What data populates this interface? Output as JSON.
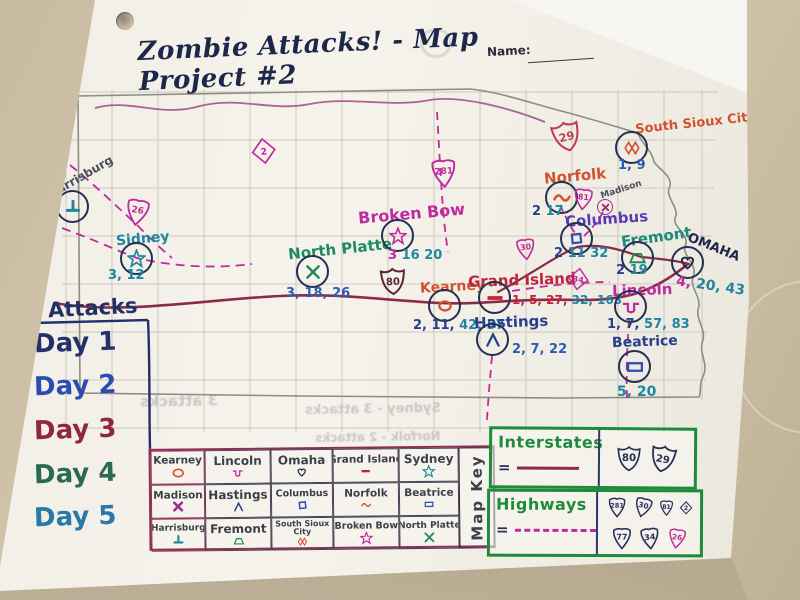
{
  "title": "Zombie Attacks! - Map Project #2",
  "name_label": "Name:",
  "attacks_panel": {
    "header": "Attacks",
    "days": [
      "Day 1",
      "Day 2",
      "Day 3",
      "Day 4",
      "Day 5"
    ],
    "day_colors": [
      "#22306b",
      "#2b4db0",
      "#8e2741",
      "#2a6a55",
      "#2878a8"
    ]
  },
  "cities": [
    {
      "name": "Harrisburg",
      "symbol": "perpendicular",
      "label_color": "#4a4f5c",
      "numbers_a": "",
      "numbers_a_color": "",
      "numbers_b": "",
      "numbers_b_color": ""
    },
    {
      "name": "Sidney",
      "symbol": "star",
      "label_color": "#1f86a0",
      "numbers_a": "3, 12",
      "numbers_a_color": "#1f86a0",
      "numbers_b": "",
      "numbers_b_color": ""
    },
    {
      "name": "North Platte",
      "symbol": "x-cross",
      "label_color": "#1d8a60",
      "numbers_a": "3, 18, 26",
      "numbers_a_color": "#2b5cb0",
      "numbers_b": "",
      "numbers_b_color": ""
    },
    {
      "name": "Broken Bow",
      "symbol": "star",
      "label_color": "#bf2a9e",
      "numbers_a": "3",
      "numbers_a_color": "#bf2a9e",
      "numbers_b": "16 20",
      "numbers_b_color": "#1f86a0"
    },
    {
      "name": "Kearney",
      "symbol": "circle-o",
      "label_color": "#d2512e",
      "numbers_a": "2, 11,",
      "numbers_a_color": "#27408b",
      "numbers_b": "42, 57",
      "numbers_b_color": "#1f86a0"
    },
    {
      "name": "Grand Island",
      "symbol": "bar",
      "label_color": "#c0233a",
      "numbers_a": "1, 5, 27,",
      "numbers_a_color": "#c0233a",
      "numbers_b": "32, 163",
      "numbers_b_color": "#1f86a0"
    },
    {
      "name": "Hastings",
      "symbol": "caret",
      "label_color": "#27408b",
      "numbers_a": "2, 7, 22",
      "numbers_a_color": "#2b5cb0",
      "numbers_b": "",
      "numbers_b_color": ""
    },
    {
      "name": "Norfolk",
      "symbol": "wave",
      "label_color": "#d2512e",
      "numbers_a": "2",
      "numbers_a_color": "#27408b",
      "numbers_b": "17",
      "numbers_b_color": "#1f86a0"
    },
    {
      "name": "Madison",
      "symbol": "bold-x",
      "label_color": "#4a4f5c",
      "numbers_a": "",
      "numbers_a_color": "",
      "numbers_b": "",
      "numbers_b_color": ""
    },
    {
      "name": "South Sioux City",
      "symbol": "double-diamond",
      "label_color": "#d2512e",
      "numbers_a": "1, 9",
      "numbers_a_color": "#2b5cb0",
      "numbers_b": "",
      "numbers_b_color": ""
    },
    {
      "name": "Columbus",
      "symbol": "square",
      "label_color": "#5b3bb5",
      "numbers_a": "2",
      "numbers_a_color": "#27408b",
      "numbers_b": "11 32",
      "numbers_b_color": "#1f86a0"
    },
    {
      "name": "Fremont",
      "symbol": "trapezoid",
      "label_color": "#1f8a7a",
      "numbers_a": "2",
      "numbers_a_color": "#27408b",
      "numbers_b": "19",
      "numbers_b_color": "#1f86a0"
    },
    {
      "name": "OMAHA",
      "symbol": "heart",
      "label_color": "#1c2749",
      "numbers_a": "4,",
      "numbers_a_color": "#bf2a9e",
      "numbers_b": "20, 43",
      "numbers_b_color": "#1f86a0"
    },
    {
      "name": "Lincoln",
      "symbol": "square-wave",
      "label_color": "#bf2a9e",
      "numbers_a": "1, 7,",
      "numbers_a_color": "#27408b",
      "numbers_b": "57, 83",
      "numbers_b_color": "#1f86a0"
    },
    {
      "name": "Beatrice",
      "symbol": "rectangle",
      "label_color": "#27408b",
      "numbers_a": "5, 20",
      "numbers_a_color": "#1f86a0",
      "numbers_b": "",
      "numbers_b_color": ""
    }
  ],
  "map_shields": [
    {
      "number": "26",
      "type": "highway",
      "color": "#bf2a9e"
    },
    {
      "number": "2",
      "type": "diamond",
      "color": "#bf2a9e"
    },
    {
      "number": "281",
      "type": "highway",
      "color": "#bf2a9e"
    },
    {
      "number": "29",
      "type": "interstate",
      "color": "#c23b52"
    },
    {
      "number": "81",
      "type": "highway",
      "color": "#bf2a9e"
    },
    {
      "number": "30",
      "type": "highway",
      "color": "#bf2a9e"
    },
    {
      "number": "34",
      "type": "highway",
      "color": "#bf2a9e"
    },
    {
      "number": "80",
      "type": "interstate",
      "color": "#5a2338"
    }
  ],
  "map_key": {
    "vertical_label": "Map Key",
    "rows": [
      [
        {
          "name": "Kearney",
          "symbol": "circle-o"
        },
        {
          "name": "Lincoln",
          "symbol": "square-wave"
        },
        {
          "name": "Omaha",
          "symbol": "heart"
        },
        {
          "name": "Grand Island",
          "symbol": "bar"
        },
        {
          "name": "Sydney",
          "symbol": "star"
        }
      ],
      [
        {
          "name": "Madison",
          "symbol": "bold-x"
        },
        {
          "name": "Hastings",
          "symbol": "caret"
        },
        {
          "name": "Columbus",
          "symbol": "square"
        },
        {
          "name": "Norfolk",
          "symbol": "wave"
        },
        {
          "name": "Beatrice",
          "symbol": "rectangle"
        }
      ],
      [
        {
          "name": "Harrisburg",
          "symbol": "perpendicular"
        },
        {
          "name": "Fremont",
          "symbol": "trapezoid"
        },
        {
          "name": "South Sioux City",
          "symbol": "double-diamond"
        },
        {
          "name": "Broken Bow",
          "symbol": "star"
        },
        {
          "name": "North Platte",
          "symbol": "x-cross"
        }
      ]
    ]
  },
  "legend": {
    "interstates_label": "Interstates",
    "highways_label": "Highways",
    "equals_sign": "=",
    "interstate_shields": [
      "80",
      "29"
    ],
    "highway_shields_row1": [
      "281",
      "30",
      "81",
      "2"
    ],
    "highway_shields_row2": [
      "77",
      "34",
      "26"
    ]
  },
  "ghost_text": [
    "3 attacks",
    "Sydney - 3 attacks",
    "Norfolk - 2 attacks"
  ],
  "colors": {
    "ink_navy": "#1c2749",
    "teal": "#1f86a0",
    "magenta": "#bf2a9e",
    "orange_red": "#d2512e",
    "red": "#c0233a",
    "green": "#1d8a57",
    "interstate_road": "#8c2a4a",
    "legend_green": "#1e8a3c"
  }
}
